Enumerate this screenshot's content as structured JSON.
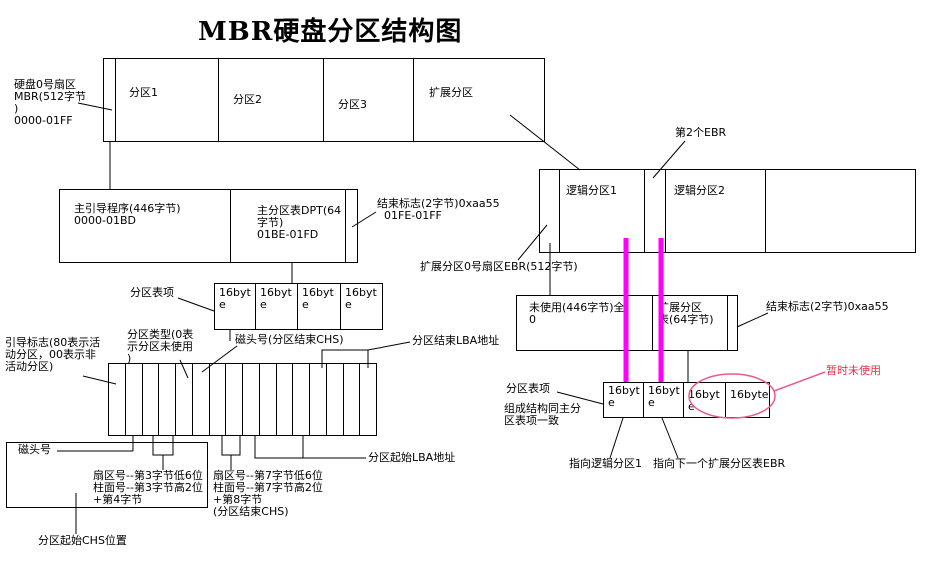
{
  "title": "MBR硬盘分区结构图",
  "colors": {
    "magenta": "#ff00ff",
    "pink": "#ea5c8a",
    "red": "#e8304a"
  },
  "byte_cell_label": "16byte",
  "disk": {
    "sector0_label": "硬盘0号扇区\nMBR(512字节\n)\n0000-01FF",
    "partition1": "分区1",
    "partition2": "分区2",
    "partition3": "分区3",
    "extended": "扩展分区"
  },
  "mbr": {
    "boot_program": "主引导程序(446字节)\n0000-01BD",
    "dpt": "主分区表DPT(64\n字节)\n01BE-01FD",
    "end_flag": "结束标志(2字节)0xaa55\n  01FE-01FF",
    "entry_label": "分区表项"
  },
  "entry": {
    "boot_flag": "引导标志(80表示活\n动分区，00表示非\n活动分区)",
    "part_type": "分区类型(0表\n示分区未使用\n)",
    "head_end_chs": "磁头号(分区结束CHS)",
    "end_lba": "分区结束LBA地址",
    "head_no": "磁头号",
    "sector3": "扇区号--第3字节低6位\n柱面号--第3字节高2位\n+第4字节",
    "sector7": "扇区号--第7字节低6位\n柱面号--第7字节高2位\n+第8字节\n(分区结束CHS)",
    "start_lba": "分区起始LBA地址",
    "start_chs": "分区起始CHS位置"
  },
  "ext": {
    "second_ebr": "第2个EBR",
    "logical1": "逻辑分区1",
    "logical2": "逻辑分区2",
    "ebr_sector": "扩展分区0号扇区EBR(512字节)",
    "unused": "未使用(446字节)全\n0",
    "ext_table": "扩展分区\n表(64字节)",
    "end_flag": "结束标志(2字节)0xaa55",
    "entry_label": "分区表项",
    "same_structure": "组成结构同主分\n区表项一致",
    "point_logical1": "指向逻辑分区1",
    "point_next_ebr": "指向下一个扩展分区表EBR",
    "temp_unused": "暂时未使用"
  }
}
